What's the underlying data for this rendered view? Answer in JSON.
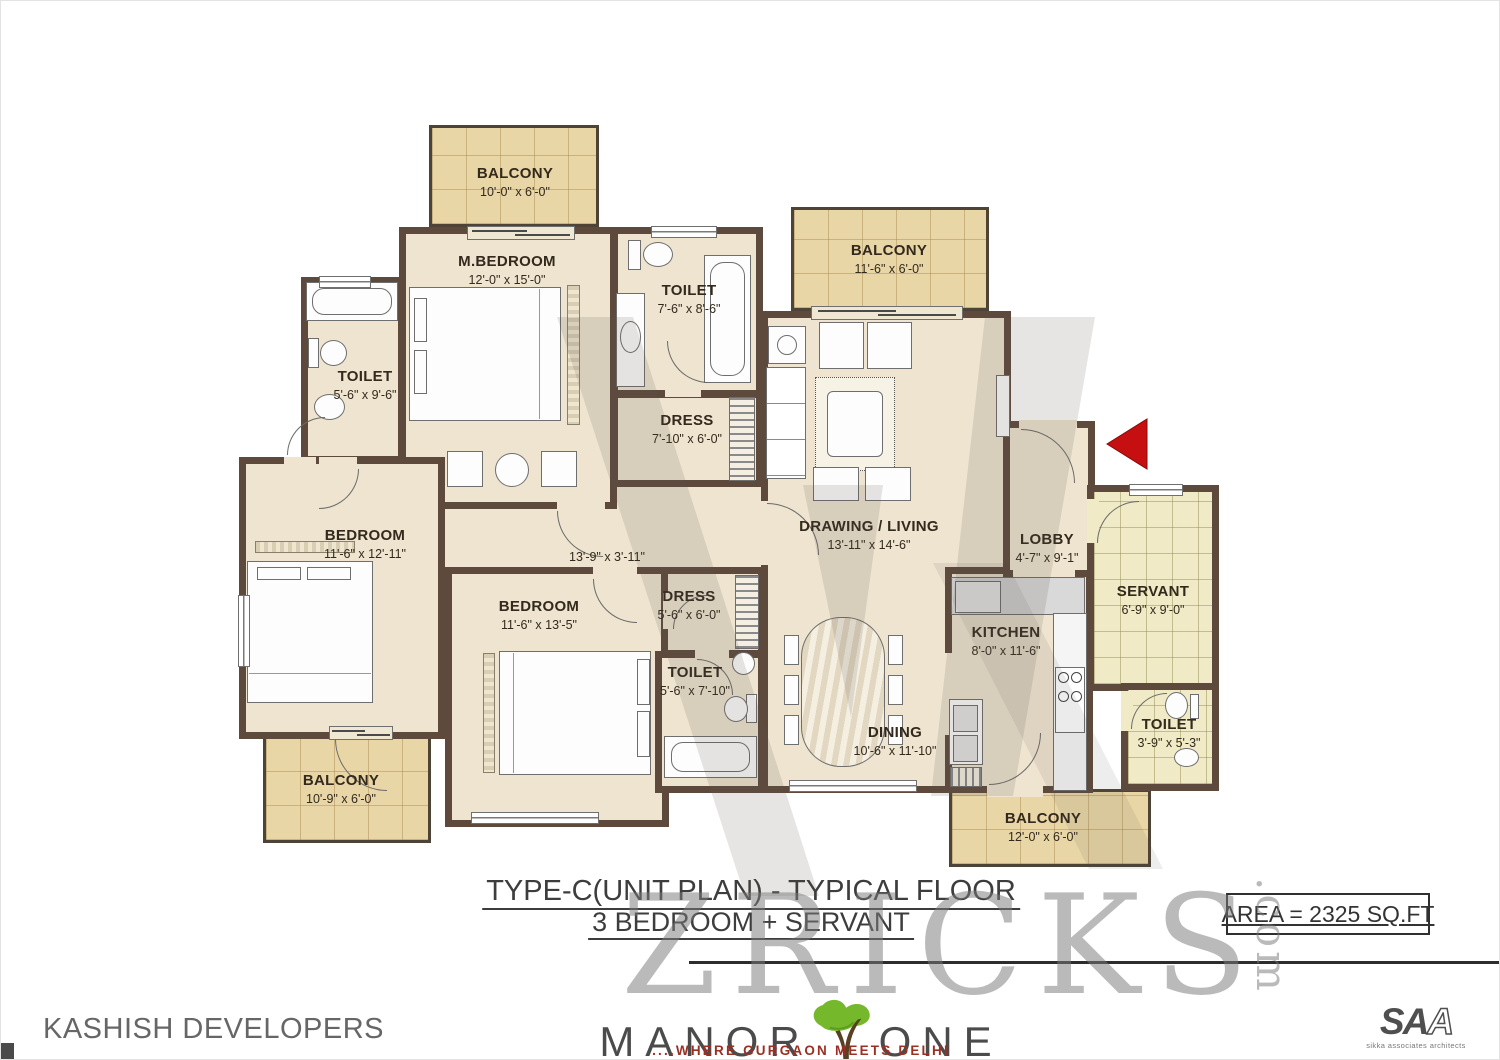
{
  "plan": {
    "rooms": [
      {
        "name": "BALCONY",
        "dims": "10'-0\" x 6'-0\""
      },
      {
        "name": "M.BEDROOM",
        "dims": "12'-0\" x 15'-0\""
      },
      {
        "name": "TOILET",
        "dims": "7'-6\" x 8'-6\""
      },
      {
        "name": "TOILET",
        "dims": "5'-6\" x 9'-6\""
      },
      {
        "name": "DRESS",
        "dims": "7'-10\" x 6'-0\""
      },
      {
        "name": "BALCONY",
        "dims": "11'-6\" x 6'-0\""
      },
      {
        "name": "DRAWING / LIVING",
        "dims": "13'-11\" x 14'-6\""
      },
      {
        "name": "BEDROOM",
        "dims": "11'-6\" x 12'-11\""
      },
      {
        "name": "",
        "dims": "13'-9\" x 3'-11\""
      },
      {
        "name": "BEDROOM",
        "dims": "11'-6\" x 13'-5\""
      },
      {
        "name": "DRESS",
        "dims": "5'-6\" x 6'-0\""
      },
      {
        "name": "TOILET",
        "dims": "5'-6\" x 7'-10\""
      },
      {
        "name": "DINING",
        "dims": "10'-6\" x 11'-10\""
      },
      {
        "name": "KITCHEN",
        "dims": "8'-0\" x 11'-6\""
      },
      {
        "name": "LOBBY",
        "dims": "4'-7\" x 9'-1\""
      },
      {
        "name": "SERVANT",
        "dims": "6'-9\" x 9'-0\""
      },
      {
        "name": "TOILET",
        "dims": "3'-9\" x 5'-3\""
      },
      {
        "name": "BALCONY",
        "dims": "10'-9\" x 6'-0\""
      },
      {
        "name": "BALCONY",
        "dims": "12'-0\" x 6'-0\""
      }
    ]
  },
  "title": {
    "line1": "TYPE-C(UNIT PLAN) - TYPICAL FLOOR",
    "line2": "3 BEDROOM + SERVANT"
  },
  "area_label": "AREA = 2325 SQ.FT",
  "watermark": {
    "text": "ZRICKS",
    "suffix": ".com"
  },
  "footer": {
    "developer": "KASHISH DEVELOPERS",
    "brand_left": "MANOR",
    "brand_right": "ONE",
    "tagline": "....WHERE GURGAON MEETS DELHI",
    "architect_logo": "SA",
    "architect_logo_last": "A",
    "architect_label": "sikka associates architects"
  },
  "colors": {
    "wall": "#5d4a3c",
    "floor": "#eee4cf",
    "balcony_floor": "#e9d6a6",
    "servant_tiles": "#f0ebc6",
    "entry_arrow": "#c60f10",
    "tree_green": "#76b82b",
    "tagline_red": "#9c2f23"
  }
}
